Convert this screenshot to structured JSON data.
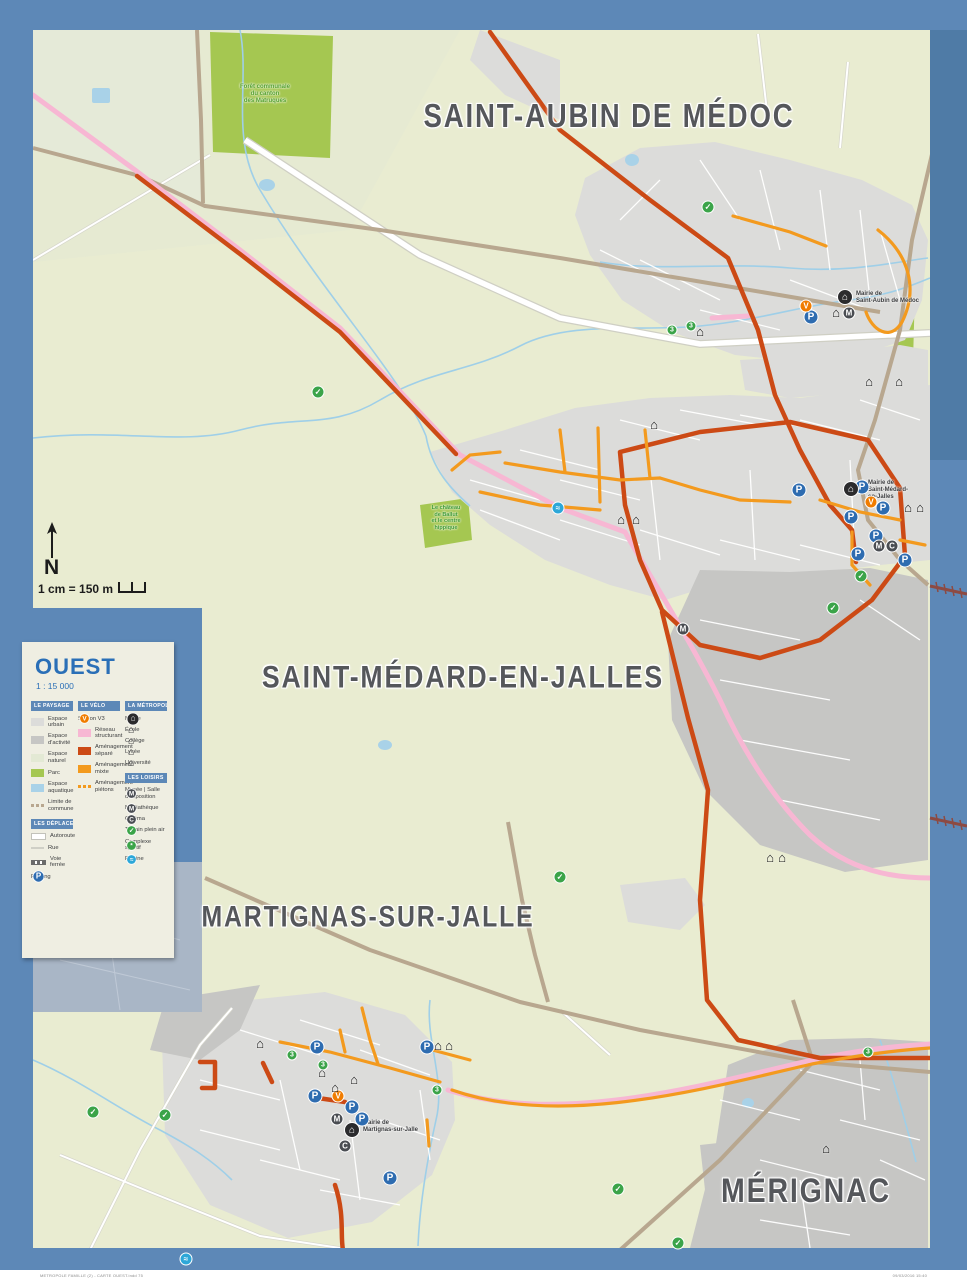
{
  "panel": {
    "title": "OUEST",
    "scale_ratio": "1 : 15 000"
  },
  "compass": {
    "letter": "N",
    "scale_text": "1 cm = 150 m"
  },
  "communes": [
    {
      "label": "SAINT-AUBIN DE MÉDOC",
      "x": 609,
      "y": 117,
      "size": 30
    },
    {
      "label": "SAINT-MÉDARD-EN-JALLES",
      "x": 463,
      "y": 678,
      "size": 29
    },
    {
      "label": "MARTIGNAS-SUR-JALLE",
      "x": 368,
      "y": 917,
      "size": 27
    },
    {
      "label": "MÉRIGNAC",
      "x": 806,
      "y": 1191,
      "size": 31
    }
  ],
  "place_labels": [
    {
      "id": "forest-label",
      "lines": [
        "Forêt communale",
        "du canton",
        "des Matruques"
      ],
      "x": 265,
      "y": 84,
      "color": "#55a12f",
      "size": 6,
      "align": "center"
    },
    {
      "id": "chateau-label",
      "lines": [
        "Le château",
        "de Ballut",
        "et le centre",
        "hippique"
      ],
      "x": 446,
      "y": 505,
      "color": "#3f9b35",
      "size": 5.5,
      "align": "center"
    },
    {
      "id": "mairie-label-saint-aubin",
      "lines": [
        "Mairie de",
        "Saint-Aubin de Médoc"
      ],
      "x": 856,
      "y": 291,
      "color": "#3b3c3e",
      "size": 6,
      "align": "left"
    },
    {
      "id": "mairie-label-saint-medard",
      "lines": [
        "Mairie de",
        "Saint-Médard-",
        "en-Jalles"
      ],
      "x": 868,
      "y": 480,
      "color": "#3b3c3e",
      "size": 6,
      "align": "left"
    },
    {
      "id": "mairie-label-martignas",
      "lines": [
        "Mairie de",
        "Martignas-sur-Jalle"
      ],
      "x": 363,
      "y": 1120,
      "color": "#3b3c3e",
      "size": 6,
      "align": "left"
    }
  ],
  "legend": {
    "columns": [
      [
        {
          "title": "LE PAYSAGE",
          "items": [
            {
              "label": "Espace urbain",
              "sw": "box",
              "c": "#dcdcda"
            },
            {
              "label": "Espace d'activité",
              "sw": "box",
              "c": "#c6c6c4"
            },
            {
              "label": "Espace naturel",
              "sw": "box",
              "c": "#e3e9d4"
            },
            {
              "label": "Parc",
              "sw": "box",
              "c": "#a5c751"
            },
            {
              "label": "Espace aquatique",
              "sw": "box",
              "c": "#a9d2e8"
            },
            {
              "label": "Limite de commune",
              "sw": "dash",
              "c": "#b8a78f"
            }
          ]
        },
        {
          "title": "LES DÉPLACEMENTS",
          "items": [
            {
              "label": "Autoroute",
              "sw": "line",
              "c": "#ffffff"
            },
            {
              "label": "Rue",
              "sw": "thin",
              "c": "#d9d9d2"
            },
            {
              "label": "Voie ferrée",
              "sw": "rail",
              "c": "#6b6b6b"
            },
            {
              "label": "Parking",
              "sw": "icon",
              "t": "parking"
            }
          ]
        }
      ],
      [
        {
          "title": "LE VÉLO",
          "items": [
            {
              "label": "Station V3",
              "sw": "icon",
              "t": "v3"
            },
            {
              "label": "Réseau structurant",
              "sw": "box",
              "c": "#f7b7d3"
            },
            {
              "label": "Aménagement séparé",
              "sw": "box",
              "c": "#cc4a15"
            },
            {
              "label": "Aménagement mixte",
              "sw": "box",
              "c": "#f39a1e"
            },
            {
              "label": "Aménagement piétons",
              "sw": "dasho",
              "c": "#f39a1e"
            }
          ]
        }
      ],
      [
        {
          "title": "LA MÉTROPOLE",
          "items": [
            {
              "label": "Mairie",
              "sw": "icon",
              "t": "mairie"
            },
            {
              "label": "École",
              "sw": "icon",
              "t": "school"
            },
            {
              "label": "Collège",
              "sw": "icon",
              "t": "school"
            },
            {
              "label": "Lycée",
              "sw": "icon",
              "t": "school"
            },
            {
              "label": "Université",
              "sw": "icon",
              "t": "school"
            }
          ]
        },
        {
          "title": "LES LOISIRS",
          "items": [
            {
              "label": "Musée | Salle d'exposition",
              "sw": "icon",
              "t": "musee"
            },
            {
              "label": "Médiathèque",
              "sw": "icon",
              "t": "mediatheque"
            },
            {
              "label": "Cinéma",
              "sw": "icon",
              "t": "cinema"
            },
            {
              "label": "Terrain plein air",
              "sw": "icon",
              "t": "sport"
            },
            {
              "label": "Complexe sportif",
              "sw": "icon",
              "t": "sport2"
            },
            {
              "label": "Piscine",
              "sw": "icon",
              "t": "piscine"
            }
          ]
        }
      ]
    ]
  },
  "icons": [
    {
      "t": "parking",
      "x": 811,
      "y": 317
    },
    {
      "t": "parking",
      "x": 799,
      "y": 490
    },
    {
      "t": "parking",
      "x": 862,
      "y": 487
    },
    {
      "t": "parking",
      "x": 851,
      "y": 517
    },
    {
      "t": "parking",
      "x": 883,
      "y": 508
    },
    {
      "t": "parking",
      "x": 876,
      "y": 536
    },
    {
      "t": "parking",
      "x": 858,
      "y": 554
    },
    {
      "t": "parking",
      "x": 905,
      "y": 560
    },
    {
      "t": "parking",
      "x": 317,
      "y": 1047
    },
    {
      "t": "parking",
      "x": 427,
      "y": 1047
    },
    {
      "t": "parking",
      "x": 315,
      "y": 1096
    },
    {
      "t": "parking",
      "x": 352,
      "y": 1107
    },
    {
      "t": "parking",
      "x": 362,
      "y": 1119
    },
    {
      "t": "parking",
      "x": 390,
      "y": 1178
    },
    {
      "t": "v3",
      "x": 806,
      "y": 306
    },
    {
      "t": "v3",
      "x": 871,
      "y": 502
    },
    {
      "t": "v3",
      "x": 338,
      "y": 1096
    },
    {
      "t": "mairie",
      "x": 845,
      "y": 297
    },
    {
      "t": "mairie",
      "x": 851,
      "y": 489
    },
    {
      "t": "mairie",
      "x": 352,
      "y": 1130
    },
    {
      "t": "school",
      "x": 836,
      "y": 312
    },
    {
      "t": "school",
      "x": 700,
      "y": 331
    },
    {
      "t": "school",
      "x": 621,
      "y": 519
    },
    {
      "t": "school",
      "x": 636,
      "y": 519
    },
    {
      "t": "school",
      "x": 654,
      "y": 424
    },
    {
      "t": "school",
      "x": 869,
      "y": 381
    },
    {
      "t": "school",
      "x": 899,
      "y": 381
    },
    {
      "t": "school",
      "x": 908,
      "y": 507
    },
    {
      "t": "school",
      "x": 920,
      "y": 507
    },
    {
      "t": "school",
      "x": 826,
      "y": 1148
    },
    {
      "t": "school",
      "x": 260,
      "y": 1043
    },
    {
      "t": "school",
      "x": 438,
      "y": 1045
    },
    {
      "t": "school",
      "x": 449,
      "y": 1045
    },
    {
      "t": "school",
      "x": 322,
      "y": 1072
    },
    {
      "t": "school",
      "x": 335,
      "y": 1087
    },
    {
      "t": "school",
      "x": 354,
      "y": 1079
    },
    {
      "t": "school",
      "x": 770,
      "y": 857
    },
    {
      "t": "school",
      "x": 782,
      "y": 857
    },
    {
      "t": "mediatheque",
      "x": 849,
      "y": 313
    },
    {
      "t": "mediatheque",
      "x": 879,
      "y": 546
    },
    {
      "t": "mediatheque",
      "x": 337,
      "y": 1119
    },
    {
      "t": "cinema",
      "x": 892,
      "y": 546
    },
    {
      "t": "cinema",
      "x": 345,
      "y": 1146
    },
    {
      "t": "musee",
      "x": 683,
      "y": 629
    },
    {
      "t": "sport",
      "x": 318,
      "y": 392
    },
    {
      "t": "sport",
      "x": 708,
      "y": 207
    },
    {
      "t": "sport",
      "x": 861,
      "y": 576
    },
    {
      "t": "sport",
      "x": 833,
      "y": 608
    },
    {
      "t": "sport",
      "x": 560,
      "y": 877
    },
    {
      "t": "sport",
      "x": 93,
      "y": 1112
    },
    {
      "t": "sport",
      "x": 165,
      "y": 1115
    },
    {
      "t": "sport",
      "x": 618,
      "y": 1189
    },
    {
      "t": "sport",
      "x": 678,
      "y": 1243
    },
    {
      "t": "piscine",
      "x": 558,
      "y": 508
    },
    {
      "t": "piscine",
      "x": 186,
      "y": 1259
    },
    {
      "t": "badge",
      "n": "3",
      "x": 672,
      "y": 330
    },
    {
      "t": "badge",
      "n": "3",
      "x": 691,
      "y": 326
    },
    {
      "t": "badge",
      "n": "3",
      "x": 868,
      "y": 1052
    },
    {
      "t": "badge",
      "n": "3",
      "x": 292,
      "y": 1055
    },
    {
      "t": "badge",
      "n": "3",
      "x": 323,
      "y": 1065
    },
    {
      "t": "badge",
      "n": "3",
      "x": 437,
      "y": 1090
    }
  ],
  "footer": {
    "left": "METROPOLE FAMILLE (2) - CARTE OUEST.indd 75",
    "right": "09/03/2016 15:40"
  },
  "colors": {
    "frame": "#5d88b7",
    "map_base": "#e9ecd1",
    "urban": "#dcdcda",
    "activity": "#c6c6c4",
    "natural": "#e3e9d4",
    "park": "#a5c751",
    "water": "#a9d2e8",
    "boundary": "#b8a78f",
    "network_pink": "#f7b7d3",
    "lane_separated": "#cc4a15",
    "lane_mixed": "#f39a1e",
    "railway": "#8d4a42",
    "parking_blue": "#2e6cb0",
    "leisure_green": "#3ba449",
    "pool_blue": "#2da7d8",
    "label_grey": "#55575b",
    "legend_blue": "#2a6fb7"
  }
}
